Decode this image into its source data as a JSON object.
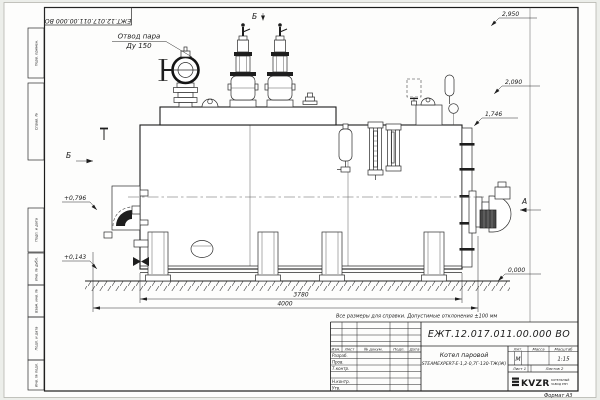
{
  "frame": {
    "doc_number_rotated": "ЕЖТ.12.017.011.00.000 ВО",
    "format_label": "Формат А3",
    "margin_labels": {
      "perv": "Перв. примен.",
      "sprav": "Справ. №",
      "podp1": "Подп. и дата",
      "inv_dubl": "Инв. № дубл.",
      "vzam": "Взам. инв. №",
      "podp2": "Подп. и дата",
      "inv_podl": "Инв. № подл."
    }
  },
  "drawing": {
    "callouts": {
      "steam_line1": "Отвод пара",
      "steam_line2": "Ду 150"
    },
    "views": {
      "top": "Б",
      "left": "Б",
      "right": "А"
    },
    "elevations": {
      "e2950": "2,950",
      "e2090": "2,090",
      "e1746": "1,746",
      "e0000": "0,000",
      "e0796": "+0,796",
      "e0143": "+0,143"
    },
    "dimensions": {
      "shell_length": "3780",
      "overall_length": "4000"
    },
    "note": "Все размеры для справки. Допустимые отклонения ±100 мм"
  },
  "title_block": {
    "doc_number": "ЕЖТ.12.017.011.00.000  ВО",
    "product_line1": "Котел паровой",
    "product_line2": "STEAMEXPERT-Е-1,2-0,7Г-130-ТЖ(Ж)",
    "headers": {
      "izm": "Изм.",
      "list": "Лист",
      "ndok": "№ докум.",
      "podp": "Подп.",
      "date": "Дата",
      "lit": "Лит.",
      "massa": "Масса",
      "scale": "Масштаб"
    },
    "roles": {
      "r1": "Разраб.",
      "r2": "Пров.",
      "r3": "Т.контр.",
      "r4": "Н.контр.",
      "r5": "Утв."
    },
    "lit_value": "М",
    "scale_value": "1:15",
    "sheet": "Лист 1",
    "sheets": "Листов 2",
    "company": {
      "logo": "KVZR",
      "line1": "КОТЕЛЬНЫЙ",
      "line2": "ЗАВОД РЭП"
    }
  }
}
